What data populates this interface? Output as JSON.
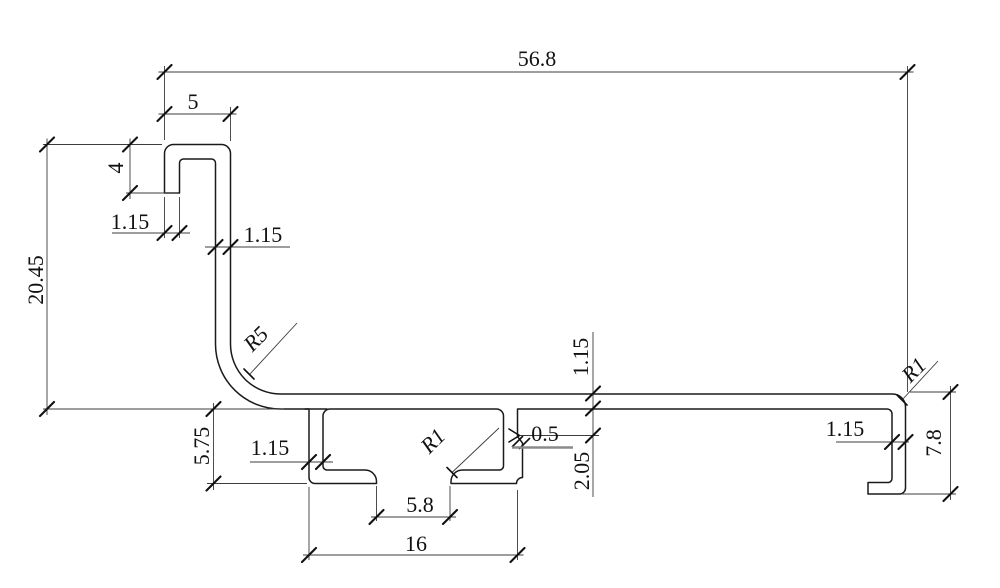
{
  "drawing": {
    "kind": "profile-cross-section-dimension-drawing",
    "colors": {
      "background": "#ffffff",
      "profile_line": "#1a1a1a",
      "dimension_line": "#3c3c3c"
    },
    "dims": {
      "overall_width": "56.8",
      "hook_width": "5",
      "hook_leg_height": "4",
      "hook_lip_thickness": "1.15",
      "stem_thickness": "1.15",
      "overall_height": "20.45",
      "bend_radius": "R5",
      "channel_depth": "5.75",
      "channel_wall_thickness": "1.15",
      "channel_toe_radius": "R1",
      "toe_gap_width": "5.8",
      "channel_outer_width": "16",
      "lip_step": "0.5",
      "lip_step_depth": "2.05",
      "web_thickness": "1.15",
      "end_leg_thickness": "1.15",
      "end_corner_radius": "R1",
      "end_height": "7.8"
    }
  }
}
